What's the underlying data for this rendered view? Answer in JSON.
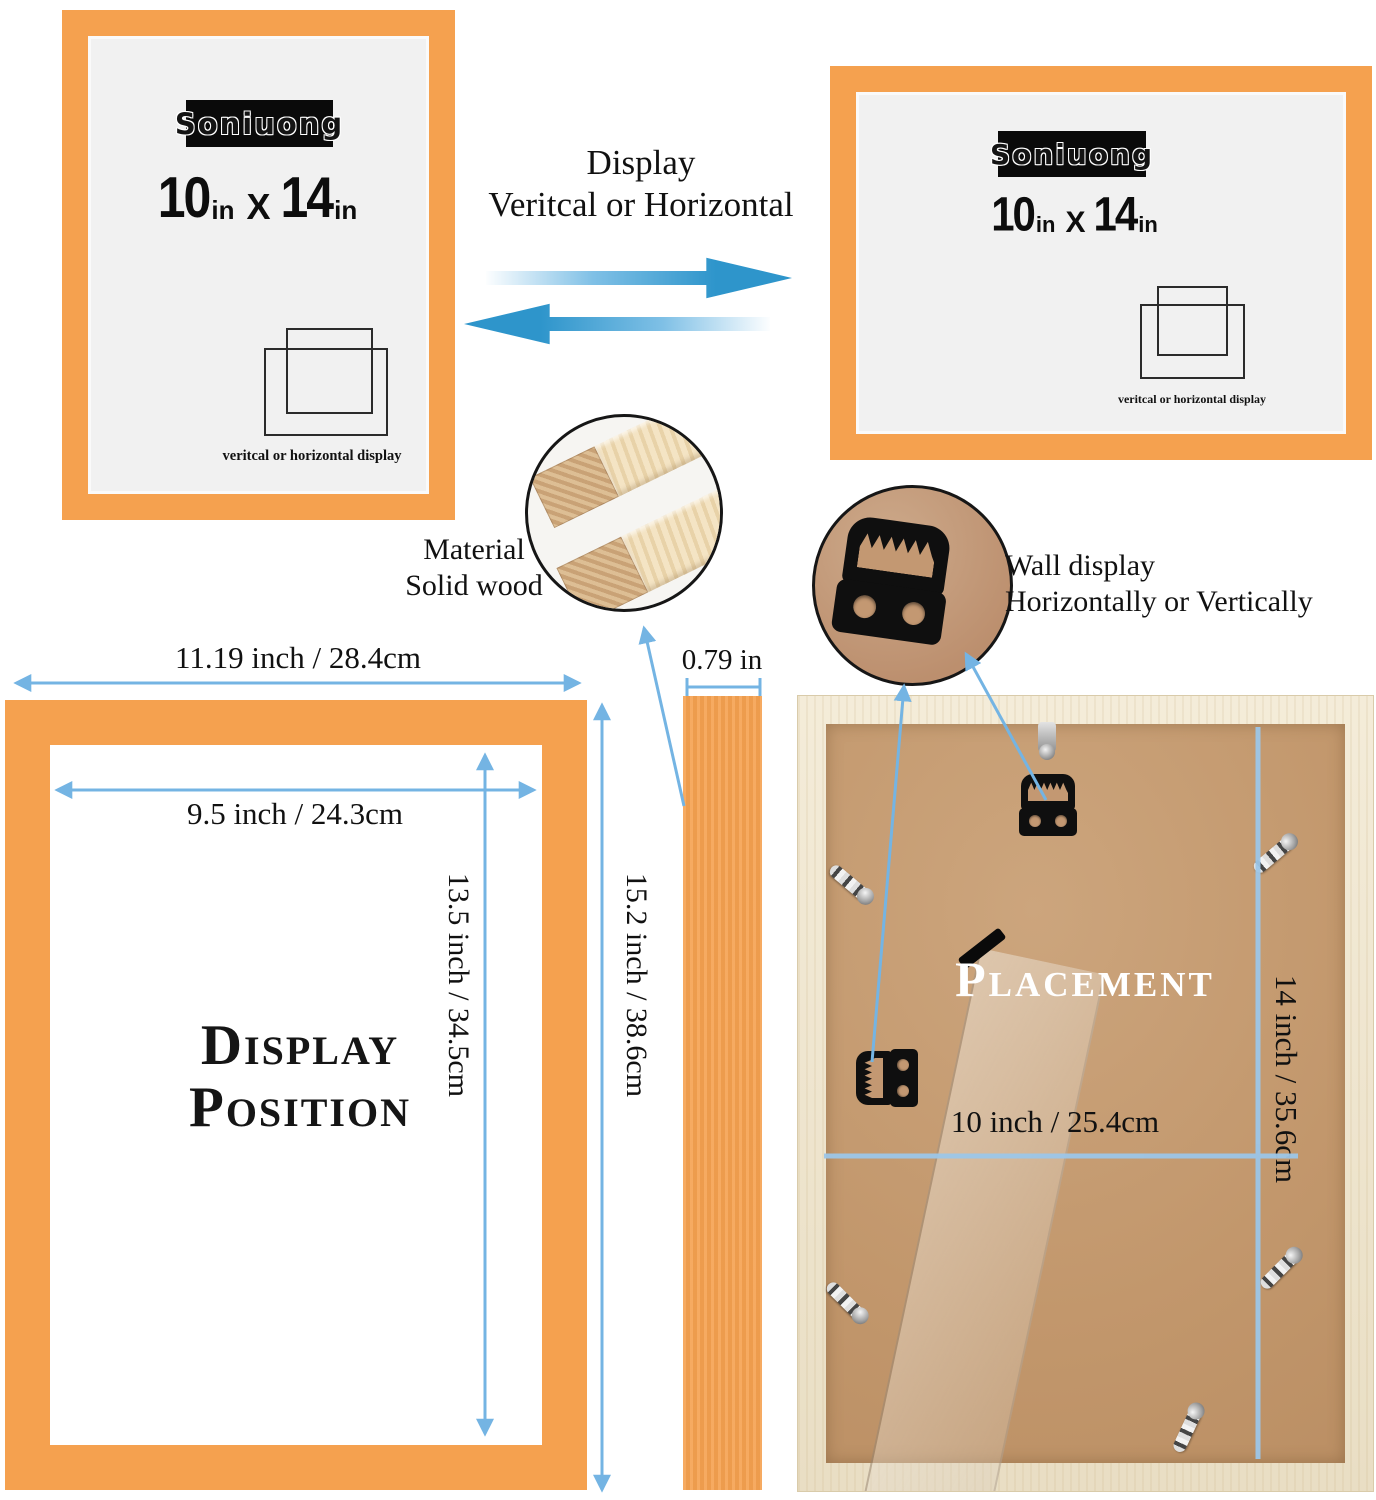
{
  "colors": {
    "frame_orange": "#F5A14F",
    "swap_arrow_blue": "#2E95CB",
    "dimension_blue": "#74B4E3",
    "back_line_blue": "#9CC6E8",
    "wood_border": "#EFE5CE",
    "cardboard": "#C69E74"
  },
  "icons": {
    "orientation": "overlapping-squares",
    "swap": "double-horizontal-arrows",
    "hanger": "sawtooth-hanger",
    "clip": "metal-turn-clip"
  },
  "brand": {
    "name": "Soniuong"
  },
  "frame_label": {
    "width_value": "10",
    "width_unit": "in",
    "separator": "X",
    "height_value": "14",
    "height_unit": "in",
    "caption": "veritcal or horizontal display"
  },
  "display_note": {
    "line1": "Display",
    "line2": "Veritcal or Horizontal"
  },
  "material_note": {
    "line1": "Material",
    "line2": "Solid wood"
  },
  "wall_note": {
    "line1": "Wall display",
    "line2": "Horizontally or Vertically"
  },
  "dimensions": {
    "outer_width": "11.19 inch / 28.4cm",
    "inner_width": "9.5 inch / 24.3cm",
    "inner_height": "13.5 inch / 34.5cm",
    "outer_height": "15.2 inch / 38.6cm",
    "depth": "0.79 in",
    "back_width": "10 inch / 25.4cm",
    "back_height": "14 inch / 35.6cm"
  },
  "section_titles": {
    "display_position_line1": "Display",
    "display_position_line2": "Position",
    "placement": "Placement"
  }
}
